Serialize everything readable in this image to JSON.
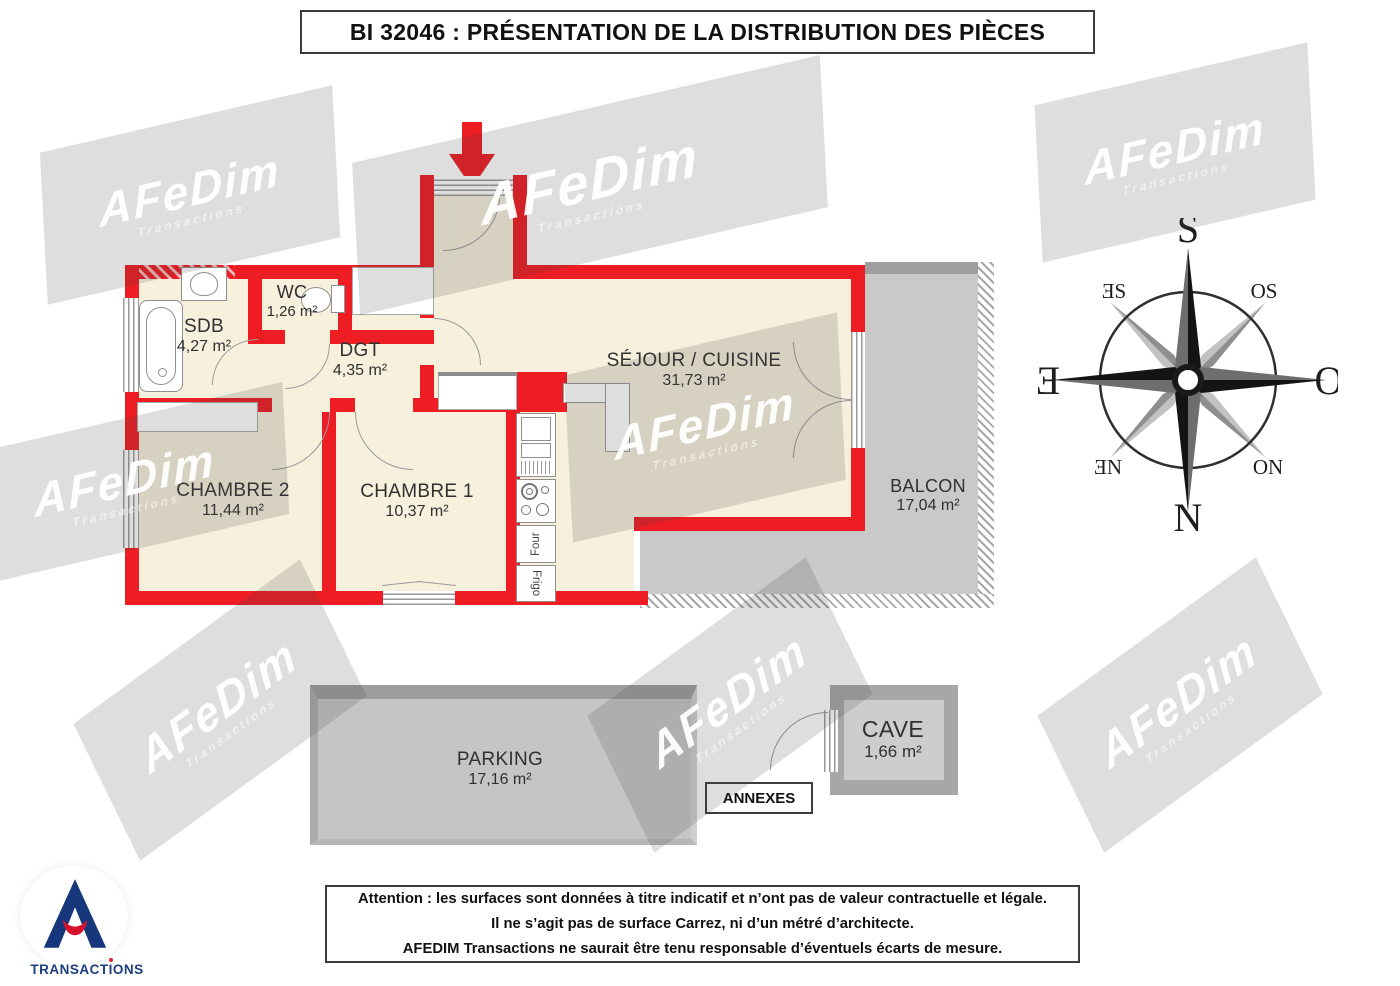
{
  "title": "BI 32046 : PRÉSENTATION DE LA DISTRIBUTION DES PIÈCES",
  "watermark": {
    "brand": "AFeDim",
    "sub": "Transactions"
  },
  "rooms": {
    "sdb": {
      "name": "SDB",
      "area": "4,27 m²"
    },
    "wc": {
      "name": "WC",
      "area": "1,26 m²"
    },
    "dgt": {
      "name": "DGT",
      "area": "4,35 m²"
    },
    "sejour": {
      "name": "SÉJOUR / CUISINE",
      "area": "31,73 m²"
    },
    "chambre2": {
      "name": "CHAMBRE 2",
      "area": "11,44 m²"
    },
    "chambre1": {
      "name": "CHAMBRE 1",
      "area": "10,37 m²"
    },
    "balcon": {
      "name": "BALCON",
      "area": "17,04 m²"
    }
  },
  "annexes": {
    "label": "ANNEXES",
    "parking": {
      "name": "PARKING",
      "area": "17,16 m²"
    },
    "cave": {
      "name": "CAVE",
      "area": "1,66 m²"
    }
  },
  "appliances": {
    "four": "Four",
    "frigo": "Frigo"
  },
  "compass": {
    "s": "S",
    "o": "O",
    "n": "N",
    "e": "Ǝ",
    "se": "ƎS",
    "so": "OS",
    "ne": "ƎN",
    "no": "ON"
  },
  "disclaimer": {
    "line1": "Attention : les surfaces sont données à titre indicatif et n’ont pas de valeur contractuelle et légale.",
    "line2": "Il ne s’agit pas de surface Carrez, ni d’un métré d’architecte.",
    "line3": "AFEDIM Transactions ne saurait être tenu responsable d’éventuels écarts de mesure."
  },
  "logo": {
    "t1": "transact",
    "t2": "i",
    "t3": "ons"
  },
  "colors": {
    "wall": "#ee1c23",
    "floor": "#f7f0dd",
    "annex_gray": "#c9c9c9"
  }
}
